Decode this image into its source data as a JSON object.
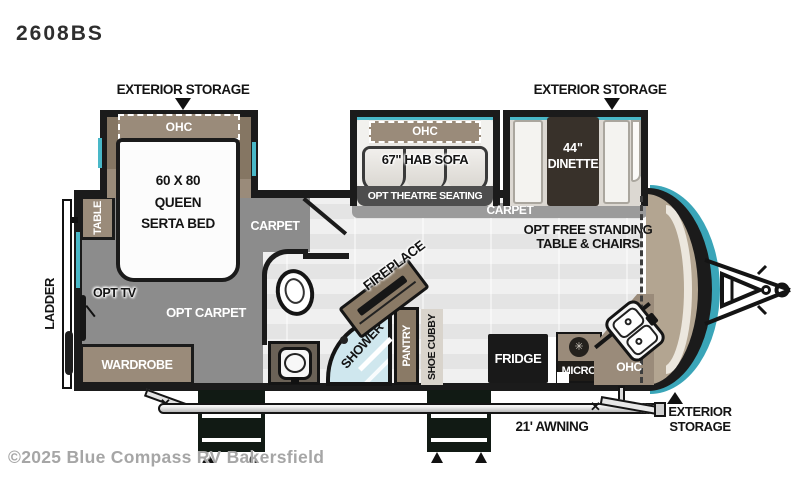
{
  "page": {
    "title": "2608BS",
    "copyright": "©2025 Blue Compass RV Bakersfield"
  },
  "callouts": {
    "storage_left": "EXTERIOR STORAGE",
    "storage_right": "EXTERIOR STORAGE",
    "storage_bottom": [
      "EXTERIOR",
      "STORAGE"
    ],
    "awning": "21' AWNING"
  },
  "bedroom": {
    "ohc": "OHC",
    "bed": [
      "60 X 80",
      "QUEEN",
      "SERTA BED"
    ],
    "carpet": "CARPET",
    "opt_carpet": "OPT CARPET",
    "opt_tv": "OPT TV",
    "wardrobe": "WARDROBE",
    "table": "TABLE",
    "ladder": "LADDER"
  },
  "living": {
    "ohc": "OHC",
    "sofa": "67\" HAB SOFA",
    "theatre": "OPT THEATRE SEATING",
    "carpet": "CARPET",
    "dinette": [
      "44\"",
      "DINETTE"
    ],
    "free_standing": [
      "OPT FREE STANDING",
      "TABLE & CHAIRS"
    ],
    "fireplace": "FIREPLACE"
  },
  "bath": {
    "shower": "SHOWER",
    "pantry": "PANTRY",
    "shoe_cubby": "SHOE CUBBY"
  },
  "kitchen": {
    "fridge": "FRIDGE",
    "micro": "MICRO",
    "ohc": "OHC"
  },
  "colors": {
    "wall": "#1b1b1b",
    "teal_accent": "#49b8c8",
    "cabinet_tan": "#9a8b7a",
    "carpet_gray": "#8c8c8c",
    "shower_blue": "#cfe7ee"
  }
}
